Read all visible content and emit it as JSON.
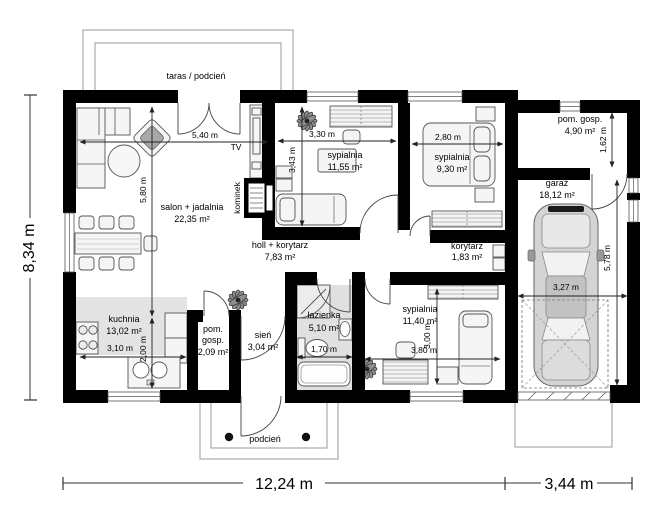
{
  "plan": {
    "rooms": {
      "taras": {
        "name": "taras / podcień"
      },
      "salon": {
        "name": "salon + jadalnia",
        "area": "22,35 m²"
      },
      "syp1": {
        "name": "sypialnia",
        "area": "11,55 m²"
      },
      "syp2": {
        "name": "sypialnia",
        "area": "9,30 m²"
      },
      "syp3": {
        "name": "sypialnia",
        "area": "11,40 m²"
      },
      "pomgosp": {
        "name": "pom. gosp.",
        "area": "4,90 m²"
      },
      "garaz": {
        "name": "garaż",
        "area": "18,12 m²"
      },
      "holl": {
        "name": "holl + korytarz",
        "area": "7,83 m²"
      },
      "korytarz": {
        "name": "korytarz",
        "area": "1,83 m²"
      },
      "kuchnia": {
        "name": "kuchnia",
        "area": "13,02 m²"
      },
      "pomgosp2": {
        "l1": "pom.",
        "l2": "gosp.",
        "area": "2,09 m²"
      },
      "sien": {
        "name": "sień",
        "area": "3,04 m²"
      },
      "lazienka": {
        "name": "łazienka",
        "area": "5,10 m²"
      },
      "podcien": {
        "name": "podcień"
      }
    },
    "fixtures": {
      "tv": "TV",
      "kominek": "kominek"
    },
    "dims": {
      "salon_w": "5,40 m",
      "salon_h": "5,80 m",
      "syp1_w": "3,30 m",
      "syp1_h": "3,43 m",
      "syp2_w": "2,80 m",
      "pomgosp_h": "1,62 m",
      "garaz_w": "3,27 m",
      "garaz_h": "5,78 m",
      "kuchnia_w": "3,10 m",
      "kuchnia_h": "2,00 m",
      "lazienka_w": "1,70 m",
      "syp3_w": "3,80 m",
      "syp3_h": "3,00 m",
      "total_h": "8,34 m",
      "main_w": "12,24 m",
      "garage_w": "3,44 m"
    }
  }
}
